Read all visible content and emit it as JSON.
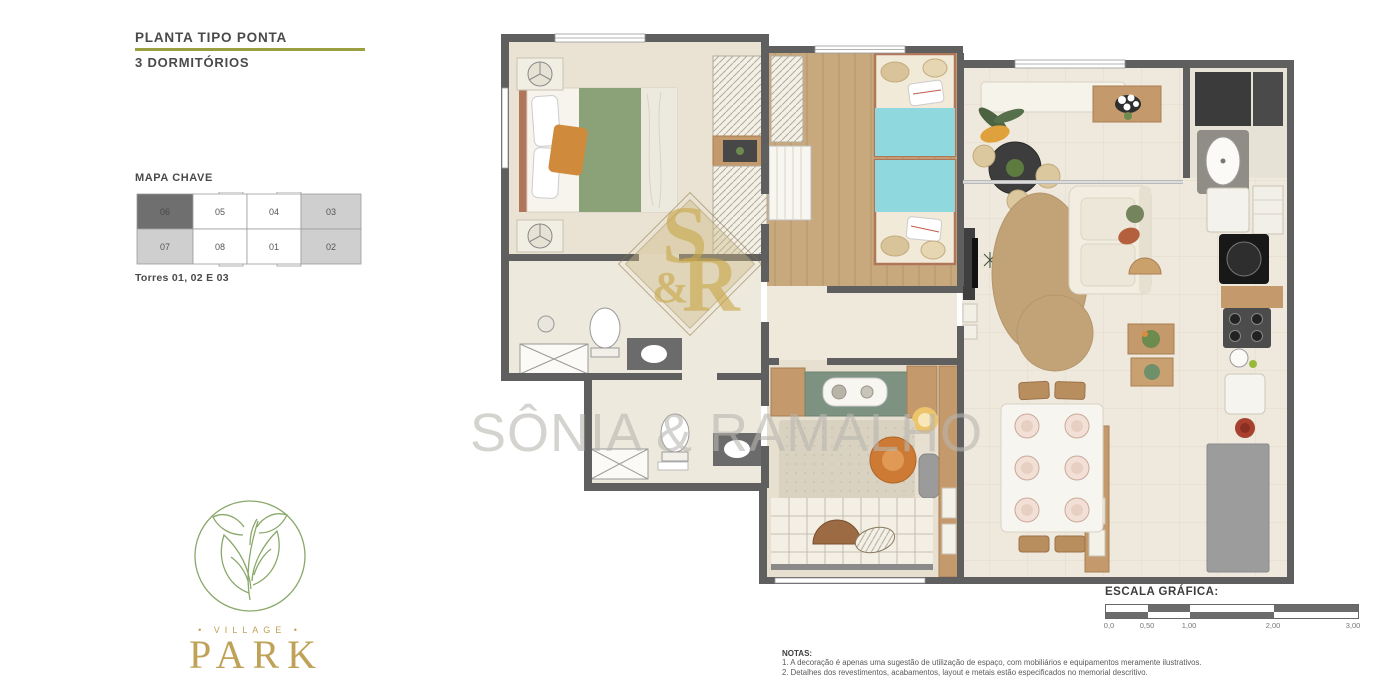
{
  "header": {
    "title": "PLANTA TIPO PONTA",
    "subtitle": "3 DORMITÓRIOS",
    "accent_color": "#9aa03f"
  },
  "keymap": {
    "label": "MAPA CHAVE",
    "caption": "Torres 01, 02 E 03",
    "highlight_color": "#6f6f6f",
    "shaded_color": "#cfcfcf",
    "units": [
      {
        "label": "06",
        "state": "highlighted"
      },
      {
        "label": "05",
        "state": "normal"
      },
      {
        "label": "04",
        "state": "normal"
      },
      {
        "label": "03",
        "state": "shaded"
      },
      {
        "label": "07",
        "state": "shaded"
      },
      {
        "label": "08",
        "state": "normal"
      },
      {
        "label": "01",
        "state": "normal"
      },
      {
        "label": "02",
        "state": "shaded"
      }
    ]
  },
  "floorplan": {
    "wall_color": "#5f5f5f",
    "wood_color": "#c8a97e",
    "green_wall_color": "#7e9282",
    "cyan_bed_color": "#8fd9de",
    "green_blanket_color": "#8ba178",
    "elements": [
      "double-bed",
      "nightstand-fan",
      "wardrobe",
      "closet-rack",
      "dresser",
      "twin-beds",
      "bathroom-1-shower",
      "bathroom-1-toilet",
      "bathroom-1-vanity",
      "bathroom-2-shower",
      "bathroom-2-toilet",
      "bathroom-2-vanity",
      "balcony-bench",
      "balcony-round-table",
      "flower-console",
      "sofa",
      "tv-panel",
      "round-rug",
      "side-tables",
      "dining-table",
      "dining-plates",
      "buffet",
      "green-accent-wall",
      "desk",
      "wall-lamp",
      "rattan-chair",
      "ottoman",
      "window-mat",
      "leaf-fan-decor",
      "washer",
      "laundry-tub",
      "fridge",
      "oven",
      "cooktop",
      "kitchen-sink",
      "cutting-board",
      "red-plate",
      "kitchen-island"
    ]
  },
  "watermark": {
    "monogram_top": "S",
    "monogram_amp": "&",
    "monogram_r": "R",
    "text": "SÔNIA & RAMALHO",
    "gold": "#c9a84c"
  },
  "logo": {
    "village": "• VILLAGE •",
    "park": "PARK",
    "green": "#8aa86a",
    "gold": "#bfa258"
  },
  "scale": {
    "label": "ESCALA GRÁFICA:",
    "ticks": [
      "0,0",
      "0,50",
      "1,00",
      "2,00",
      "3,00"
    ]
  },
  "notes": {
    "heading": "NOTAS:",
    "items": [
      "1. A decoração é apenas uma sugestão de utilização de espaço, com mobiliários e equipamentos meramente ilustrativos.",
      "2. Detalhes dos revestimentos, acabamentos, layout e metais estão especificados no memorial descritivo."
    ]
  }
}
